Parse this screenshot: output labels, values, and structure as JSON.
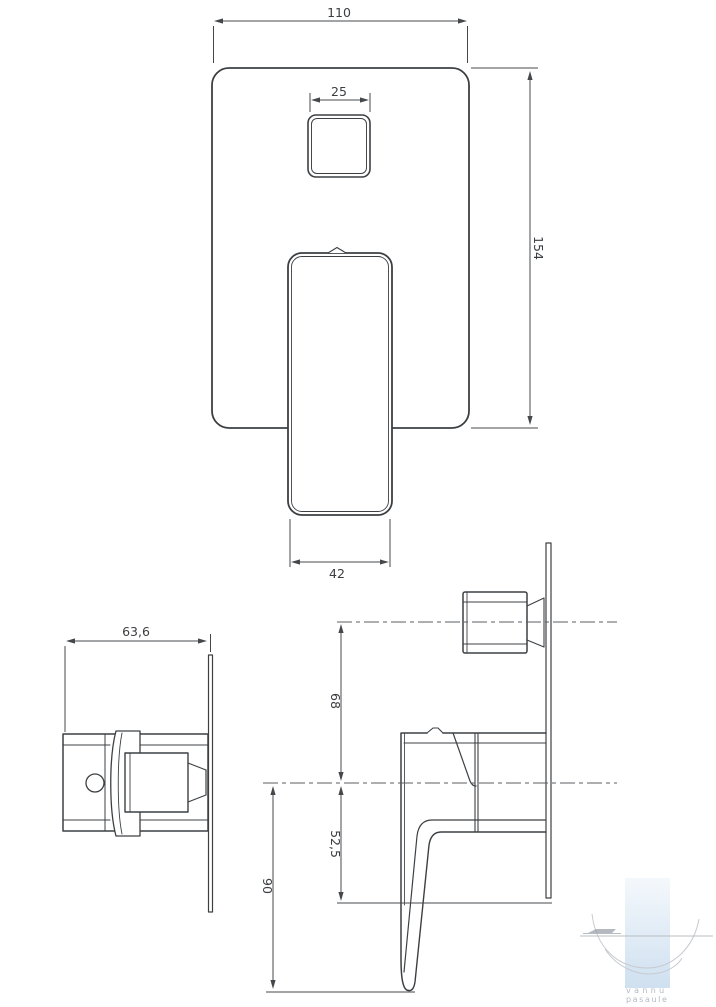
{
  "drawing": {
    "front_view": {
      "width": "110",
      "button_width": "25",
      "height": "154",
      "handle_width": "42"
    },
    "top_view": {
      "depth": "63,6"
    },
    "side_view": {
      "diverter_offset": "68",
      "plate_bottom_offset": "52,5",
      "handle_drop": "90"
    },
    "colors": {
      "line": "#3d4043",
      "dim_line": "#45484b",
      "centerline": "#595c5f",
      "text": "#3b3e42",
      "background": "#ffffff"
    }
  },
  "watermark": {
    "line1": "vannu",
    "line2": "pasaule",
    "text_color": "#b3bac3",
    "bar_top_color": "#f4f8fc",
    "bar_bottom_color": "#cfe0f0",
    "arc_color": "#c6cad0",
    "line_color": "#b9bdc2",
    "streak_color": "#9aa2aa"
  }
}
